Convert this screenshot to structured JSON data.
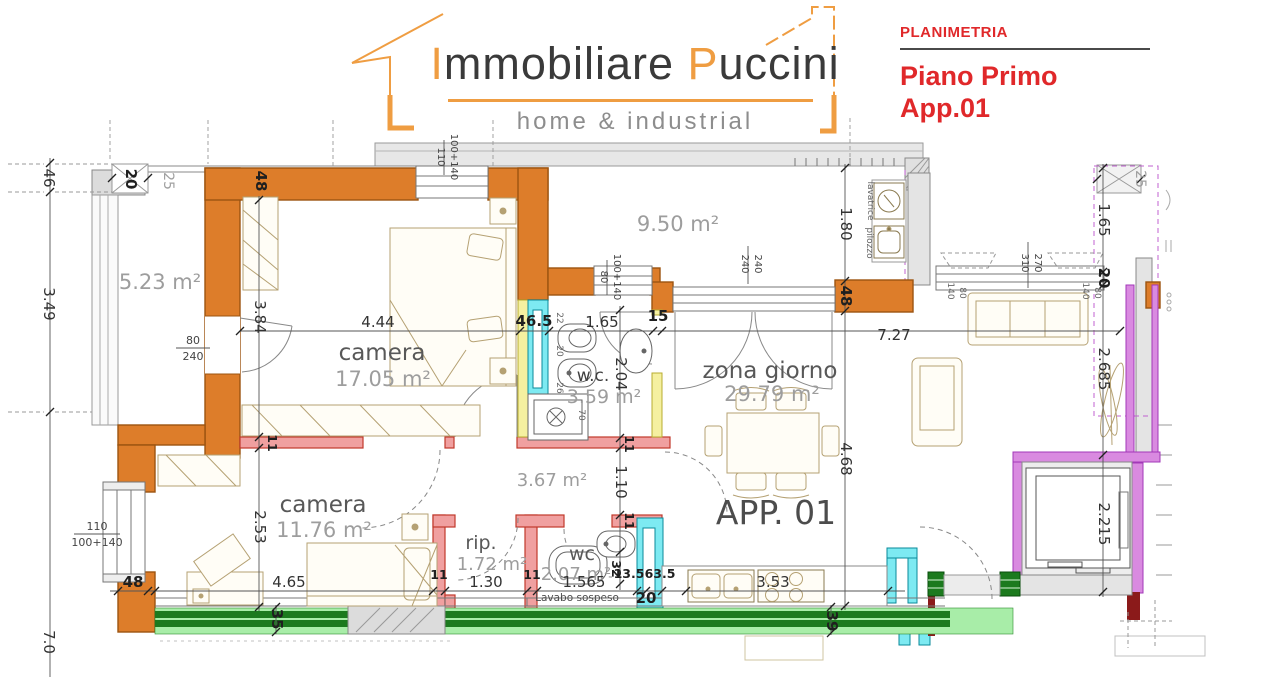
{
  "header": {
    "brand": {
      "word1": "Immobiliare",
      "word2": "Puccini",
      "tagline": "home & industrial"
    },
    "panel": {
      "kicker": "PLANIMETRIA",
      "title": "Piano Primo",
      "subtitle": "App.01"
    }
  },
  "plan": {
    "apartment_label": "APP. 01",
    "rooms": {
      "terrace_small": {
        "area": "5.23 m²"
      },
      "camera_1": {
        "name": "camera",
        "area": "17.05 m²"
      },
      "terrace_large": {
        "area": "9.50 m²"
      },
      "wc_main": {
        "name": "w.c.",
        "area": "3.59 m²"
      },
      "living": {
        "name": "zona giorno",
        "area": "29.79 m²"
      },
      "camera_2": {
        "name": "camera",
        "area": "11.76 m²"
      },
      "hallway": {
        "area": "3.67 m²"
      },
      "storage": {
        "name": "rip.",
        "area": "1.72 m²"
      },
      "wc_small": {
        "name": "wc",
        "area": "2.07 m²"
      }
    },
    "fixtures": {
      "lavabo": "Lavabo sospeso",
      "lavatrice": "lavatrice",
      "pilozzo": "pilozzo"
    },
    "dimensions": {
      "left_46": "46",
      "left_349": "3.49",
      "left_70": "7.0",
      "tl_20": "20",
      "tl_25": "25",
      "tl_48": "48",
      "v_384": "3.84",
      "v_253": "2.53",
      "h_444": "4.44",
      "h_465_wall": "46.5",
      "h_165_wc": "1.65",
      "h_15": "15",
      "h_727": "7.27",
      "v_180": "1.80",
      "v_48_r": "48",
      "v_468": "4.68",
      "v_204": "2.04",
      "v_110": "1.10",
      "v_32": "32",
      "r_165": "1.65",
      "r_20": "20",
      "r_25": "25",
      "r_2685": "2.685",
      "r_2215": "2.215",
      "b_48": "48",
      "b_465": "4.65",
      "b_130": "1.30",
      "b_1565": "1.565",
      "b_135": "13.5",
      "b_635": "63.5",
      "b_20": "20",
      "b_353": "3.53",
      "b_35": "35",
      "b_39": "39",
      "t11_a": "11",
      "t11_b": "11",
      "t11_c": "11",
      "t11_d": "11",
      "t11_e": "11",
      "wc_22": "22",
      "wc_20": "20",
      "wc_26": "26",
      "wc_70": "70"
    },
    "window_labels": {
      "top": [
        "110",
        "100+140"
      ],
      "left": [
        "110",
        "100+140"
      ],
      "wc": [
        "80",
        "100+140"
      ],
      "terrace_door": [
        "240",
        "240"
      ],
      "living": [
        "310",
        "270"
      ],
      "door_small": [
        "80",
        "240"
      ],
      "sofa_left": [
        "140",
        "80"
      ],
      "sofa_right": [
        "140",
        "80"
      ]
    }
  }
}
